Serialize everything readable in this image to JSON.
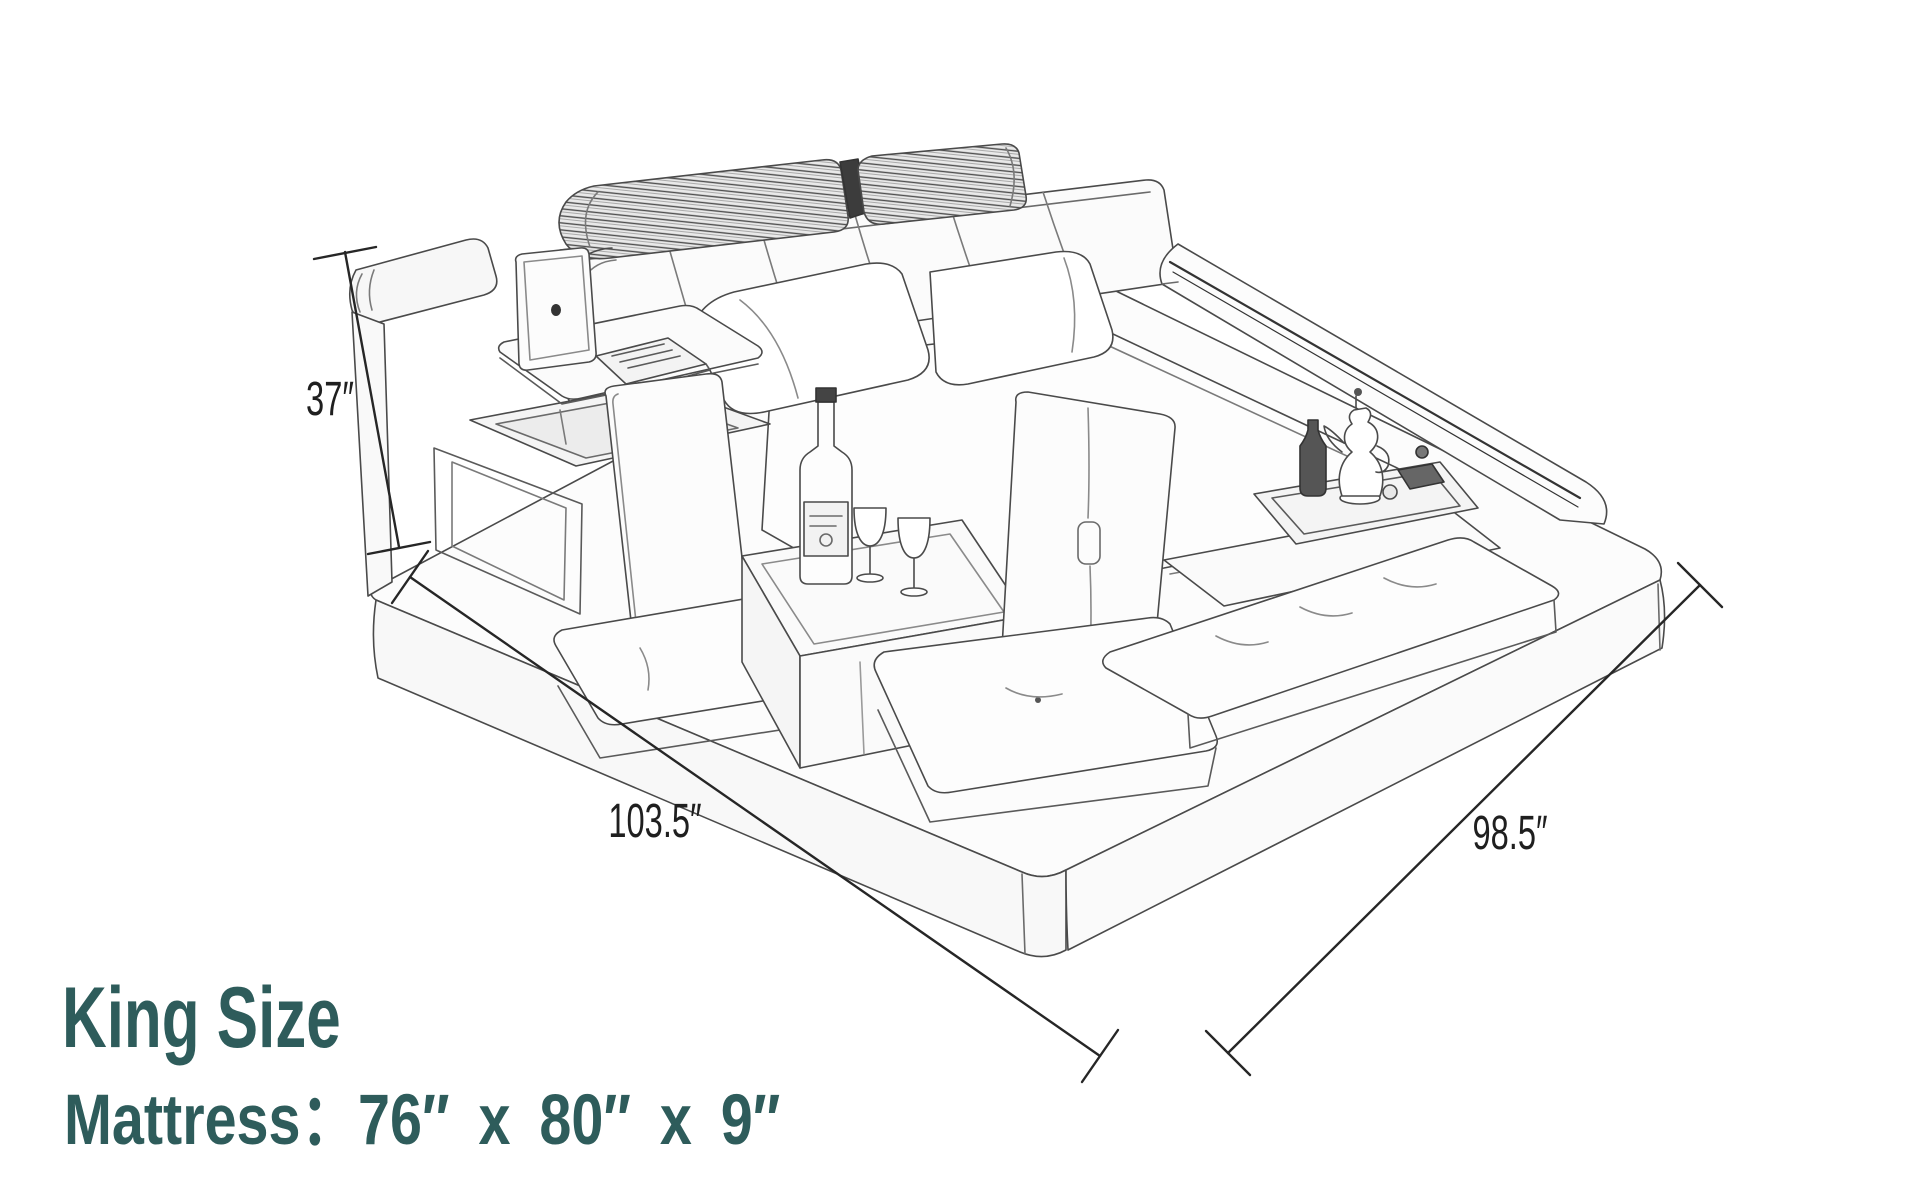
{
  "diagram": {
    "title": "King size bed dimension sketch",
    "dimensions": {
      "height_label": "37″",
      "length_label": "103.5″",
      "width_label": "98.5″"
    },
    "caption": {
      "title": "King Size",
      "spec_line": "Mattress：76″ x 80″ x 9″",
      "mattress": {
        "width_in": "76″",
        "length_in": "80″",
        "thickness_in": "9″"
      }
    },
    "colors": {
      "caption_teal": "#2e5c5b",
      "dimension_text": "#1f1f1f",
      "sketch_stroke": "#4a4a4a",
      "background": "#ffffff"
    },
    "sketch_parts": [
      "headboard",
      "headrest-bolsters",
      "led-side-rail",
      "mattress",
      "pillows",
      "storage-armrest",
      "laptop",
      "swivel-table",
      "open-storage-box",
      "seat-backrests",
      "seat-cushions",
      "glass-side-table",
      "wine-bottle",
      "wine-glasses",
      "serving-tray",
      "coffee-pot",
      "ottoman-pad",
      "platform-base"
    ]
  }
}
